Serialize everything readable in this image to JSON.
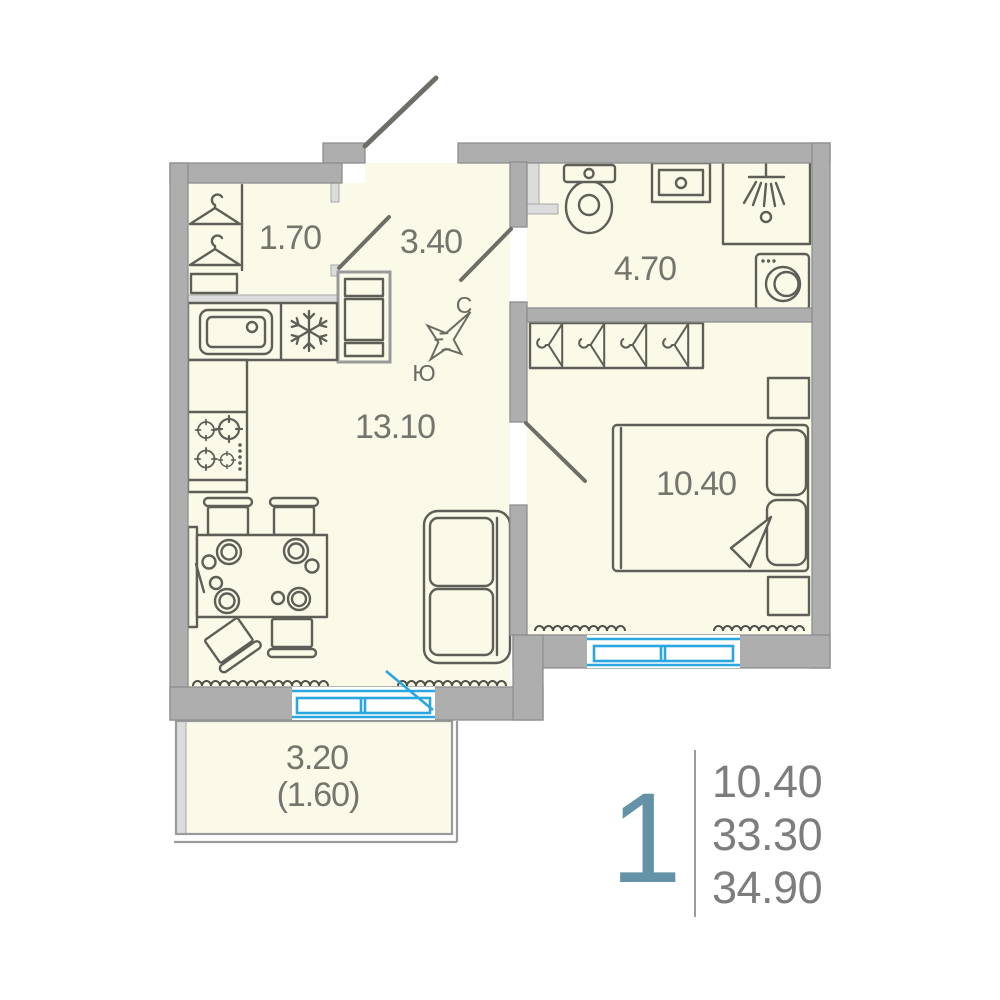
{
  "plan_type": "apartment-floor-plan",
  "areas": {
    "wardrobe": "1.70",
    "hallway": "3.40",
    "bathroom": "4.70",
    "kitchen_living": "13.10",
    "bedroom": "10.40",
    "balcony": "3.20",
    "balcony_coefficient": "(1.60)"
  },
  "compass": {
    "north": "С",
    "south": "Ю"
  },
  "summary": {
    "rooms_count": "1",
    "living_area": "10.40",
    "apartment_area": "33.30",
    "total_area": "34.90"
  },
  "icons": [
    "hanger-icon",
    "kitchen-sink-icon",
    "snowflake-fridge-icon",
    "stove-icon",
    "dining-table-icon",
    "chair-icon",
    "sofa-icon",
    "toilet-icon",
    "washbasin-icon",
    "shower-icon",
    "washing-machine-icon",
    "bed-icon",
    "pillow-icon",
    "nightstand-icon",
    "radiator-icon",
    "window-icon",
    "compass-rose-icon"
  ],
  "colors": {
    "floor": "#FBF9E8",
    "walls": "#AEAEAE",
    "light_walls": "#DCDCDC",
    "furniture_outline": "#5F5F58",
    "label_text": "#75756D",
    "window_blue": "#2AA7DF",
    "accent_number": "#6493A8",
    "summary_text": "#7D7D7D"
  }
}
